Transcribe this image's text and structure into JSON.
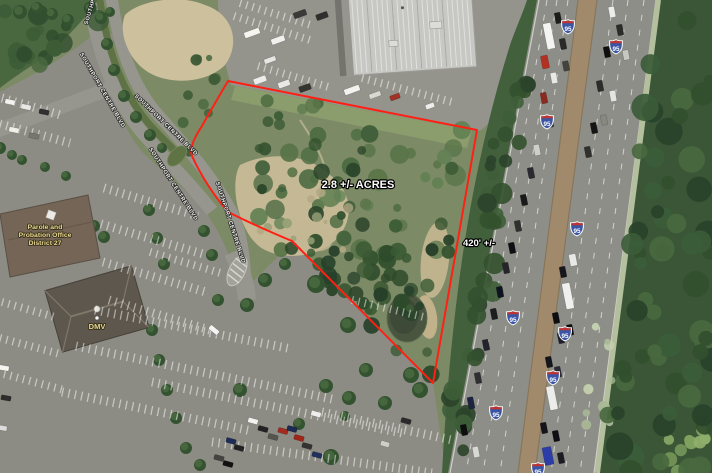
{
  "map": {
    "parcel": {
      "acreage_label": "2.8 +/- ACRES",
      "frontage_label": "420' +/-",
      "outline_color": "#ff2015"
    },
    "roads": {
      "southport_centre_blvd": "SOUTHPORT CENTRE BLVD"
    },
    "highway": {
      "route_number": "95",
      "shield_blue": "#3b55a5",
      "shield_red": "#bf3430"
    },
    "pois": {
      "parole_office": {
        "lines": [
          "Parole and",
          "Probation Office",
          "District 27"
        ],
        "label_color": "#e9d795"
      },
      "dmv": {
        "label": "DMV",
        "label_color": "#e9d795"
      }
    }
  }
}
